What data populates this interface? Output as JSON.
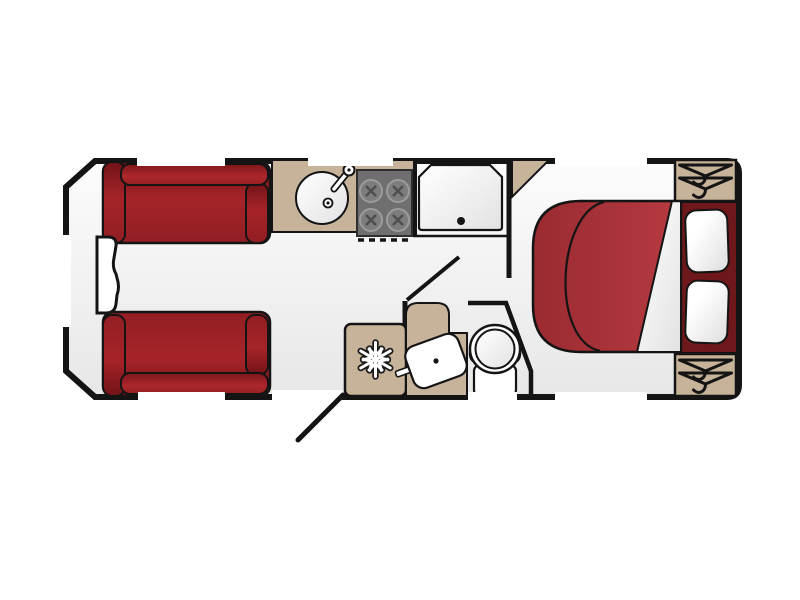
{
  "scene": {
    "kind": "caravan-floor-plan",
    "view": "top-down layout drawing",
    "areas": [
      "front-lounge",
      "kitchen",
      "shower-cubicle",
      "washroom",
      "rear-island-bedroom"
    ]
  },
  "colors": {
    "background": "#ffffff",
    "outline": "#141414",
    "floor_light": "#fcfcfc",
    "floor_dark": "#e9e9e9",
    "cabinet_tan": "#c7b29a",
    "sofa_red": "#a62429",
    "sofa_red_dark": "#721317",
    "bed_red": "#b23339",
    "headboard_maroon": "#6e181c",
    "hob_gray": "#6f6f6f",
    "burner_gray": "#7d7d7d",
    "fixture_white": "#ffffff"
  },
  "counts": {
    "windows": 7,
    "sofas": 2,
    "hob_burners": 4,
    "pillows": 2,
    "wardrobes": 2
  },
  "icons": [
    "snowflake-icon",
    "clothes-hanger-icon",
    "tap-icon",
    "drain-icon",
    "door-swing-icon"
  ],
  "fixtures": {
    "lounge": [
      "sofa-top",
      "sofa-bottom",
      "front-chest"
    ],
    "kitchen": [
      "round-sink",
      "four-burner-hob",
      "fridge"
    ],
    "washroom": [
      "shower-tray",
      "vanity-basin",
      "toilet"
    ],
    "bedroom": [
      "island-bed",
      "pillow-left",
      "pillow-right",
      "wardrobe-top",
      "wardrobe-bottom",
      "corner-cabinet"
    ]
  }
}
